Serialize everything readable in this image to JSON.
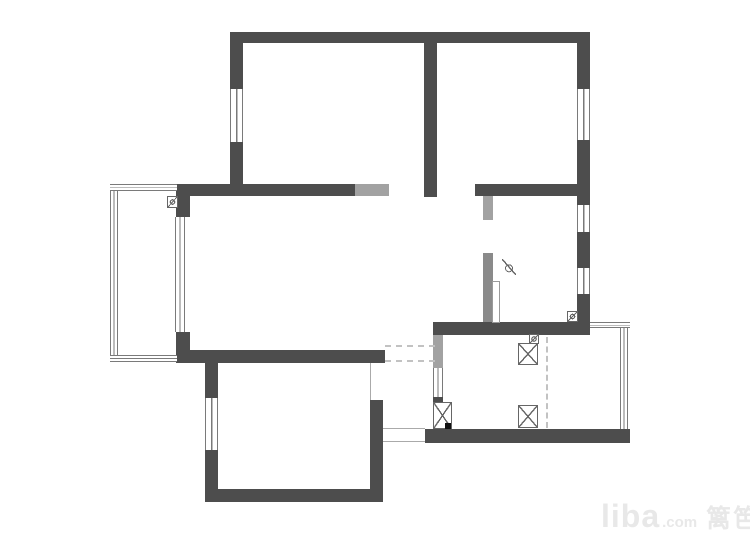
{
  "watermark": {
    "brand": "liba",
    "suffix": ".com",
    "site_name": "篱笆网"
  },
  "colors": {
    "background": "#ffffff",
    "wall": "#4d4d4d",
    "wall_mid": "#8a8a8a",
    "wall_light": "#a2a2a2",
    "window_line": "#7a7a7a",
    "thin_line": "#aaaaaa",
    "dash": "#c2c2c2",
    "symbol": "#666666",
    "watermark": "#e8e8e8"
  },
  "plan": {
    "elements": [
      {
        "name": "exterior-wall-top",
        "type": "wall",
        "x": 230,
        "y": 32,
        "w": 360,
        "h": 11
      },
      {
        "name": "bedroom1-wall-left-upper",
        "type": "wall",
        "x": 230,
        "y": 43,
        "w": 13,
        "h": 46
      },
      {
        "name": "bedroom1-wall-left-lower",
        "type": "wall",
        "x": 230,
        "y": 142,
        "w": 13,
        "h": 42
      },
      {
        "name": "bedroom-divider-wall",
        "type": "wall",
        "x": 424,
        "y": 43,
        "w": 13,
        "h": 154
      },
      {
        "name": "exterior-wall-right-1",
        "type": "wall",
        "x": 577,
        "y": 43,
        "w": 13,
        "h": 46
      },
      {
        "name": "exterior-wall-right-2",
        "type": "wall",
        "x": 577,
        "y": 140,
        "w": 13,
        "h": 65
      },
      {
        "name": "exterior-wall-right-3",
        "type": "wall",
        "x": 577,
        "y": 232,
        "w": 13,
        "h": 36
      },
      {
        "name": "exterior-wall-right-4",
        "type": "wall",
        "x": 577,
        "y": 294,
        "w": 13,
        "h": 41
      },
      {
        "name": "living-wall-top-left",
        "type": "wall",
        "x": 176,
        "y": 184,
        "w": 179,
        "h": 12
      },
      {
        "name": "living-wall-top-right",
        "type": "wall",
        "x": 475,
        "y": 184,
        "w": 115,
        "h": 12
      },
      {
        "name": "balcony-pier-top",
        "type": "wall",
        "x": 176,
        "y": 196,
        "w": 14,
        "h": 21
      },
      {
        "name": "balcony-pier-bottom",
        "type": "wall",
        "x": 176,
        "y": 332,
        "w": 14,
        "h": 30
      },
      {
        "name": "living-wall-bottom",
        "type": "wall",
        "x": 176,
        "y": 350,
        "w": 209,
        "h": 13
      },
      {
        "name": "bedroom2-wall-left-upper",
        "type": "wall",
        "x": 205,
        "y": 362,
        "w": 13,
        "h": 36
      },
      {
        "name": "bedroom2-wall-left-lower",
        "type": "wall",
        "x": 205,
        "y": 450,
        "w": 13,
        "h": 52
      },
      {
        "name": "bedroom2-wall-bottom",
        "type": "wall",
        "x": 205,
        "y": 489,
        "w": 178,
        "h": 13
      },
      {
        "name": "bedroom2-wall-right",
        "type": "wall",
        "x": 370,
        "y": 400,
        "w": 13,
        "h": 102
      },
      {
        "name": "kitchen-wall-top",
        "type": "wall",
        "x": 433,
        "y": 322,
        "w": 157,
        "h": 13
      },
      {
        "name": "kitchen-wall-bottom",
        "type": "wall",
        "x": 425,
        "y": 429,
        "w": 205,
        "h": 14
      },
      {
        "name": "kitchen-door-jamb",
        "type": "wall",
        "x": 433,
        "y": 397,
        "w": 10,
        "h": 6
      },
      {
        "name": "bedroom3-partition-lower",
        "type": "wall-mid",
        "x": 483,
        "y": 253,
        "w": 10,
        "h": 69
      },
      {
        "name": "living-wall-top-new-segment",
        "type": "wall-light",
        "x": 355,
        "y": 184,
        "w": 34,
        "h": 12
      },
      {
        "name": "bedroom3-partition-upper",
        "type": "wall-light",
        "x": 483,
        "y": 196,
        "w": 10,
        "h": 24
      },
      {
        "name": "kitchen-wall-left-new-segment",
        "type": "wall-light",
        "x": 433,
        "y": 335,
        "w": 10,
        "h": 33
      },
      {
        "name": "balcony-rail-left",
        "type": "window-v",
        "x": 110,
        "y": 184,
        "w": 8,
        "h": 178
      },
      {
        "name": "balcony-rail-top",
        "type": "window-h",
        "x": 110,
        "y": 184,
        "w": 67,
        "h": 7
      },
      {
        "name": "balcony-rail-bottom",
        "type": "window-h",
        "x": 110,
        "y": 355,
        "w": 67,
        "h": 7
      },
      {
        "name": "bedroom1-window",
        "type": "window-v",
        "x": 230,
        "y": 89,
        "w": 13,
        "h": 53
      },
      {
        "name": "bedroom4-window",
        "type": "window-v",
        "x": 577,
        "y": 89,
        "w": 13,
        "h": 51
      },
      {
        "name": "bedroom3-window-upper",
        "type": "window-v",
        "x": 577,
        "y": 205,
        "w": 13,
        "h": 27
      },
      {
        "name": "bedroom3-window-lower",
        "type": "window-v",
        "x": 577,
        "y": 268,
        "w": 13,
        "h": 26
      },
      {
        "name": "living-balcony-window",
        "type": "window-v",
        "x": 175,
        "y": 217,
        "w": 10,
        "h": 115
      },
      {
        "name": "bedroom2-window",
        "type": "window-v",
        "x": 205,
        "y": 398,
        "w": 13,
        "h": 52
      },
      {
        "name": "kitchen-window-left",
        "type": "window-v",
        "x": 433,
        "y": 368,
        "w": 10,
        "h": 29
      },
      {
        "name": "kitchen-window-right",
        "type": "window-v",
        "x": 620,
        "y": 327,
        "w": 8,
        "h": 102
      },
      {
        "name": "kitchen-rail-top-right",
        "type": "window-h",
        "x": 590,
        "y": 322,
        "w": 40,
        "h": 6
      },
      {
        "name": "doorway-edge-line",
        "type": "line-v",
        "x": 370,
        "y": 363,
        "w": 1,
        "h": 37
      },
      {
        "name": "passage-line-top",
        "type": "line-h",
        "x": 383,
        "y": 428,
        "w": 42,
        "h": 1
      },
      {
        "name": "passage-line-bottom",
        "type": "line-h",
        "x": 383,
        "y": 441,
        "w": 42,
        "h": 1
      },
      {
        "name": "opening-dash-upper",
        "type": "dash-h",
        "x": 385,
        "y": 345,
        "w": 50,
        "h": 0
      },
      {
        "name": "opening-dash-lower",
        "type": "dash-h",
        "x": 385,
        "y": 360,
        "w": 50,
        "h": 0
      },
      {
        "name": "kitchen-dash-divider",
        "type": "dash-v",
        "x": 546,
        "y": 337,
        "w": 0,
        "h": 91
      },
      {
        "name": "appliance-x-box-left",
        "type": "x-box",
        "x": 433,
        "y": 402,
        "w": 19,
        "h": 27
      },
      {
        "name": "appliance-x-box-top",
        "type": "x-box",
        "x": 518,
        "y": 343,
        "w": 20,
        "h": 22
      },
      {
        "name": "appliance-x-box-bottom",
        "type": "x-box",
        "x": 518,
        "y": 405,
        "w": 20,
        "h": 23
      },
      {
        "name": "balcony-drain-icon",
        "type": "valve-icon",
        "x": 167,
        "y": 196,
        "w": 11,
        "h": 12
      },
      {
        "name": "meter-icon",
        "type": "valve-icon",
        "x": 567,
        "y": 311,
        "w": 11,
        "h": 11
      },
      {
        "name": "gas-valve-icon",
        "type": "valve-icon",
        "x": 529,
        "y": 334,
        "w": 10,
        "h": 10
      },
      {
        "name": "diameter-mark-icon",
        "type": "slash-icon",
        "x": 502,
        "y": 259,
        "w": 14,
        "h": 16
      },
      {
        "name": "bedroom3-door-leaf",
        "type": "door-leaf",
        "x": 492,
        "y": 281,
        "w": 8,
        "h": 42
      },
      {
        "name": "corner-dot",
        "type": "dot",
        "x": 445,
        "y": 423,
        "w": 6,
        "h": 6
      }
    ]
  }
}
